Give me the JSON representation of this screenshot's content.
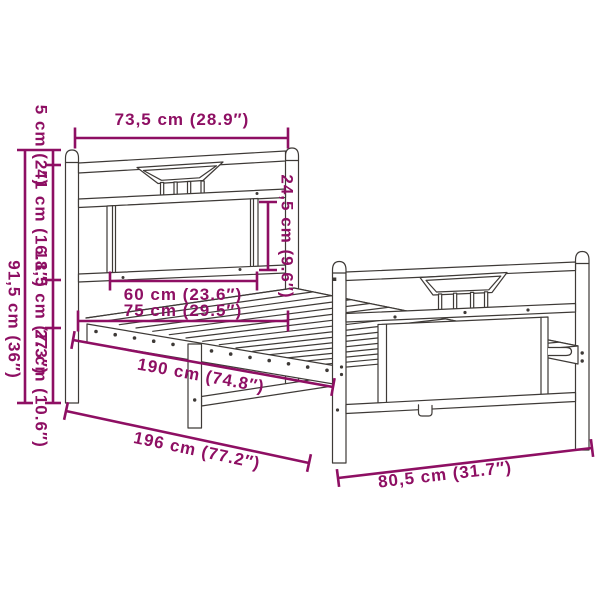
{
  "diagram": {
    "type": "product dimension drawing",
    "subject": "metal bed frame with headboard and footboard, slatted base"
  },
  "colors": {
    "dimension_accent": "#8E0F63",
    "frame_line": "#3E3A37",
    "background": "#FFFFFF"
  },
  "dims": {
    "top_width": "73,5 cm (28.9″)",
    "total_height": "91,5 cm (36″)",
    "post_cap_height": "5 cm (2″)",
    "headboard_upper_height": "41 cm (16.1″)",
    "headboard_lower_height": "18,5 cm (7.3″)",
    "under_bed_clearance": "27 cm (10.6″)",
    "panel_height": "24,5 cm (9.6″)",
    "panel_width": "60 cm (23.6″)",
    "inner_width": "75 cm (29.5″)",
    "slat_area_length": "190 cm (74.8″)",
    "total_length": "196 cm (77.2″)",
    "foot_end_width": "80,5 cm (31.7″)"
  }
}
